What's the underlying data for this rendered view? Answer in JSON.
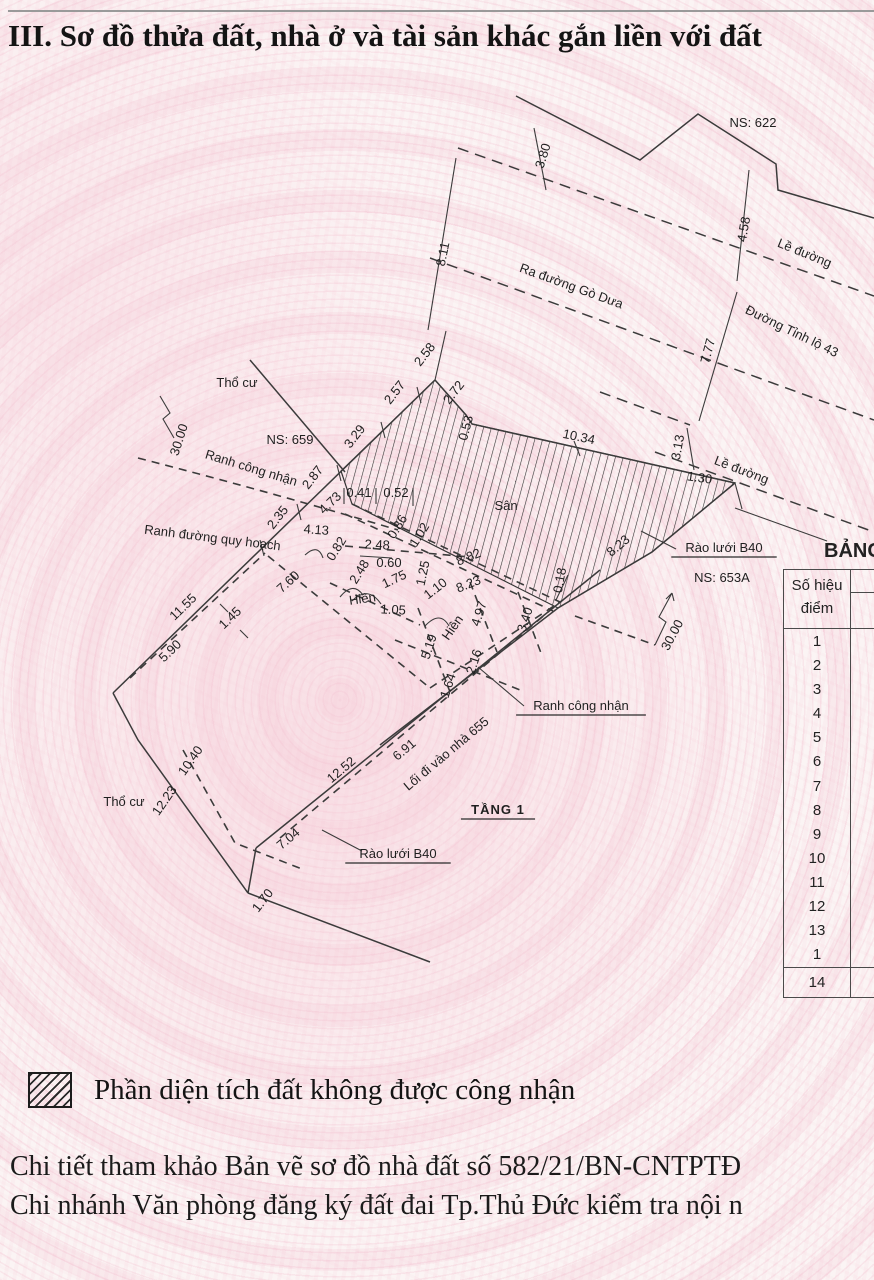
{
  "title": "III. Sơ đồ thửa đất, nhà ở và tài sản khác gắn liền với đất",
  "diagram": {
    "labels": [
      {
        "t": "NS: 622",
        "x": 753,
        "y": 127,
        "r": 0,
        "s": 16,
        "n": "label-ns-622"
      },
      {
        "t": "3.80",
        "x": 547,
        "y": 157,
        "r": -73
      },
      {
        "t": "4.58",
        "x": 748,
        "y": 230,
        "r": -80
      },
      {
        "t": "8.11",
        "x": 447,
        "y": 255,
        "r": -78
      },
      {
        "t": "7.77",
        "x": 712,
        "y": 352,
        "r": -75
      },
      {
        "t": "3.13",
        "x": 682,
        "y": 448,
        "r": -80
      },
      {
        "t": "1.30",
        "x": 699,
        "y": 482,
        "r": 8
      },
      {
        "t": "2.58",
        "x": 428,
        "y": 357,
        "r": -52
      },
      {
        "t": "2.57",
        "x": 398,
        "y": 395,
        "r": -52
      },
      {
        "t": "2.72",
        "x": 457,
        "y": 395,
        "r": -52
      },
      {
        "t": "0.53",
        "x": 470,
        "y": 429,
        "r": -75
      },
      {
        "t": "3.29",
        "x": 358,
        "y": 439,
        "r": -52
      },
      {
        "t": "2.87",
        "x": 316,
        "y": 480,
        "r": -52
      },
      {
        "t": "2.35",
        "x": 281,
        "y": 520,
        "r": -52
      },
      {
        "t": "10.34",
        "x": 578,
        "y": 441,
        "r": 12
      },
      {
        "t": "4.73",
        "x": 333,
        "y": 506,
        "r": -44
      },
      {
        "t": "0.41",
        "x": 359,
        "y": 497,
        "r": 0,
        "s": 12
      },
      {
        "t": "0.52",
        "x": 396,
        "y": 497,
        "r": 0,
        "s": 12
      },
      {
        "t": "0.86",
        "x": 401,
        "y": 529,
        "r": -58,
        "s": 12
      },
      {
        "t": "1.02",
        "x": 423,
        "y": 537,
        "r": -58,
        "s": 12
      },
      {
        "t": "4.13",
        "x": 316,
        "y": 534,
        "r": 4
      },
      {
        "t": "0.82",
        "x": 340,
        "y": 551,
        "r": -58,
        "s": 12
      },
      {
        "t": "2.48",
        "x": 377,
        "y": 549,
        "r": 3,
        "s": 12
      },
      {
        "t": "2.48",
        "x": 363,
        "y": 574,
        "r": -58,
        "s": 12
      },
      {
        "t": "0.60",
        "x": 389,
        "y": 567,
        "r": 0,
        "s": 12
      },
      {
        "t": "1.75",
        "x": 396,
        "y": 583,
        "r": -25,
        "s": 12
      },
      {
        "t": "1.25",
        "x": 427,
        "y": 574,
        "r": -78,
        "s": 12
      },
      {
        "t": "1.10",
        "x": 438,
        "y": 592,
        "r": -38,
        "s": 12
      },
      {
        "t": "1.05",
        "x": 393,
        "y": 614,
        "r": 3
      },
      {
        "t": "8.82",
        "x": 470,
        "y": 561,
        "r": -22
      },
      {
        "t": "8.23",
        "x": 470,
        "y": 588,
        "r": -22
      },
      {
        "t": "0.18",
        "x": 564,
        "y": 581,
        "r": -80,
        "s": 12
      },
      {
        "t": "8.23",
        "x": 621,
        "y": 549,
        "r": -40
      },
      {
        "t": "4.97",
        "x": 483,
        "y": 615,
        "r": -72
      },
      {
        "t": "5.19",
        "x": 433,
        "y": 648,
        "r": -72
      },
      {
        "t": "3.40",
        "x": 529,
        "y": 621,
        "r": -72
      },
      {
        "t": "2.16",
        "x": 478,
        "y": 663,
        "r": -72
      },
      {
        "t": "1.64",
        "x": 452,
        "y": 687,
        "r": -72
      },
      {
        "t": "11.55",
        "x": 186,
        "y": 610,
        "r": -44
      },
      {
        "t": "1.45",
        "x": 233,
        "y": 621,
        "r": -44
      },
      {
        "t": "5.90",
        "x": 173,
        "y": 654,
        "r": -44
      },
      {
        "t": "7.60",
        "x": 291,
        "y": 585,
        "r": -42
      },
      {
        "t": "10.40",
        "x": 194,
        "y": 763,
        "r": -55
      },
      {
        "t": "12.23",
        "x": 168,
        "y": 803,
        "r": -55
      },
      {
        "t": "7.04",
        "x": 291,
        "y": 842,
        "r": -40
      },
      {
        "t": "1.70",
        "x": 266,
        "y": 903,
        "r": -52
      },
      {
        "t": "12.52",
        "x": 344,
        "y": 773,
        "r": -40
      },
      {
        "t": "6.91",
        "x": 407,
        "y": 753,
        "r": -40
      },
      {
        "t": "30.00",
        "x": 183,
        "y": 441,
        "r": -72,
        "n": "dim-30-left"
      },
      {
        "t": "30.00",
        "x": 676,
        "y": 637,
        "r": -62,
        "n": "dim-30-right"
      },
      {
        "t": "Thổ cư",
        "x": 237,
        "y": 387,
        "r": 0,
        "s": 15,
        "n": "label-tho-cu-top"
      },
      {
        "t": "NS: 659",
        "x": 290,
        "y": 444,
        "r": 0,
        "s": 16,
        "n": "label-ns-659"
      },
      {
        "t": "Ranh công nhận",
        "x": 250,
        "y": 472,
        "r": 17,
        "s": 14,
        "n": "label-ranh-cong-nhan-upper"
      },
      {
        "t": "Ranh đường quy hoạch",
        "x": 212,
        "y": 542,
        "r": 7,
        "s": 15,
        "n": "label-ranh-duong-quy-hoach"
      },
      {
        "t": "Sân",
        "x": 506,
        "y": 510,
        "r": 0,
        "s": 15,
        "n": "label-san"
      },
      {
        "t": "Hiên",
        "x": 363,
        "y": 603,
        "r": -8,
        "s": 13,
        "n": "label-hien-1"
      },
      {
        "t": "Hiên",
        "x": 456,
        "y": 630,
        "r": -55,
        "s": 13,
        "n": "label-hien-2"
      },
      {
        "t": "Lề đường",
        "x": 803,
        "y": 257,
        "r": 22,
        "s": 14,
        "n": "label-le-duong-top"
      },
      {
        "t": "Ra đường Gò Dưa",
        "x": 570,
        "y": 290,
        "r": 20,
        "s": 14,
        "n": "label-ra-duong-go-dua"
      },
      {
        "t": "Đường Tỉnh lộ 43",
        "x": 790,
        "y": 335,
        "r": 26,
        "s": 14,
        "n": "label-duong-tinh-lo-43"
      },
      {
        "t": "Lề đường",
        "x": 740,
        "y": 474,
        "r": 21,
        "s": 14,
        "n": "label-le-duong-mid"
      },
      {
        "t": "Rào lưới B40",
        "x": 724,
        "y": 552,
        "r": 0,
        "s": 14,
        "u": true,
        "n": "label-rao-luoi-b40-right"
      },
      {
        "t": "NS: 653A",
        "x": 722,
        "y": 582,
        "r": 0,
        "s": 16,
        "n": "label-ns-653a"
      },
      {
        "t": "Ranh công nhận",
        "x": 581,
        "y": 710,
        "r": 0,
        "s": 15,
        "u": true,
        "n": "label-ranh-cong-nhan-lower"
      },
      {
        "t": "Lối đi vào nhà 655",
        "x": 449,
        "y": 757,
        "r": -40,
        "s": 14,
        "n": "label-loi-di-vao-nha-655"
      },
      {
        "t": "Thổ cư",
        "x": 124,
        "y": 806,
        "r": 0,
        "s": 15,
        "n": "label-tho-cu-bottom"
      },
      {
        "t": "Rào lưới B40",
        "x": 398,
        "y": 858,
        "r": 0,
        "s": 14,
        "u": true,
        "n": "label-rao-luoi-b40-bottom"
      },
      {
        "t": "TẦNG 1",
        "x": 498,
        "y": 814,
        "r": 0,
        "s": 19,
        "b": true,
        "u": true,
        "n": "label-tang-1"
      }
    ]
  },
  "table": {
    "title": "BẢNG",
    "header_line1": "Số hiệu",
    "header_line2": "điểm",
    "rows": [
      "1",
      "2",
      "3",
      "4",
      "5",
      "6",
      "7",
      "8",
      "9",
      "10",
      "11",
      "12",
      "13",
      "1"
    ],
    "last_row": "14"
  },
  "legend": {
    "text": "Phần diện tích đất không được công nhận"
  },
  "footer": {
    "line1": "Chi tiết tham khảo Bản vẽ sơ đồ nhà đất số 582/21/BN-CNTPTĐ",
    "line2": "Chi nhánh Văn phòng đăng ký đất đai Tp.Thủ Đức kiểm tra nội n"
  }
}
